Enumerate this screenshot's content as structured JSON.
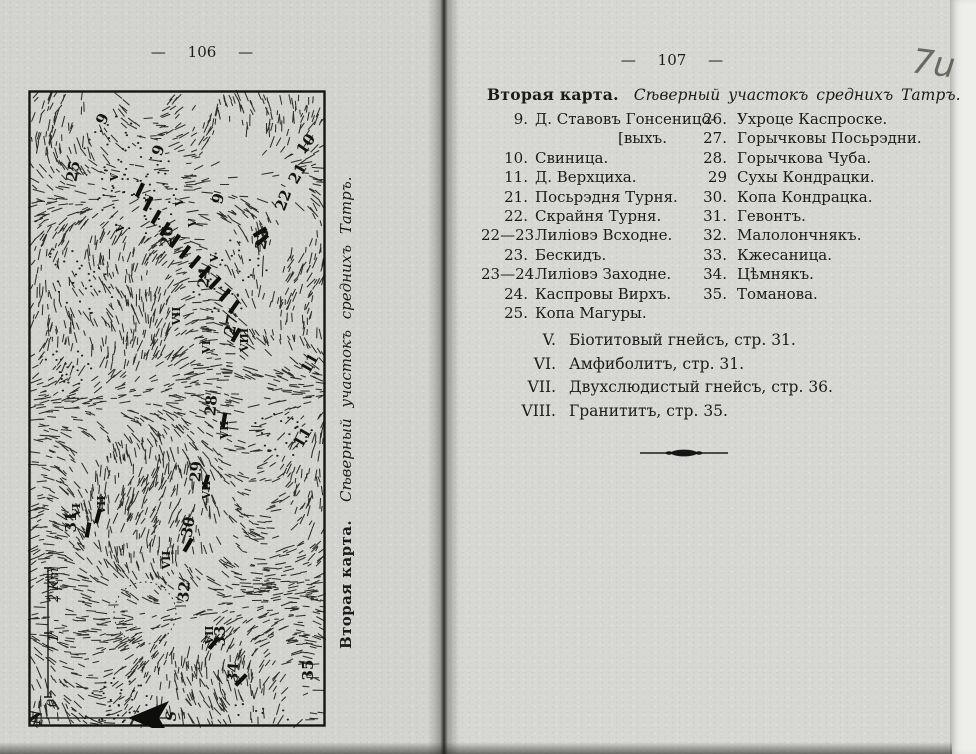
{
  "colors": {
    "ink": "#1b1b1b",
    "paper_left": "#d3d3cf",
    "paper_right": "#d7d7d3"
  },
  "scan": {
    "handwritten_mark": "7u"
  },
  "left_page": {
    "page_number": "— 106 —",
    "caption_bold": "Вторая карта.",
    "caption_italic": "Сѣверный участокъ среднихъ Татръ.",
    "map": {
      "labels": [
        {
          "t": "9",
          "x": 79,
          "y": 31,
          "r": -65
        },
        {
          "t": "9",
          "x": 135,
          "y": 62,
          "r": -70
        },
        {
          "t": "9",
          "x": 195,
          "y": 110,
          "r": -75
        },
        {
          "t": "25",
          "x": 50,
          "y": 82,
          "r": -80
        },
        {
          "t": "10",
          "x": 282,
          "y": 57,
          "r": -55
        },
        {
          "t": "21",
          "x": 274,
          "y": 86,
          "r": -60
        },
        {
          "t": "22",
          "x": 260,
          "y": 112,
          "r": -70
        },
        {
          "t": "23",
          "x": 239,
          "y": 150,
          "r": -80
        },
        {
          "t": "26",
          "x": 144,
          "y": 147,
          "r": -85
        },
        {
          "t": "24",
          "x": 181,
          "y": 188,
          "r": -85
        },
        {
          "t": "27",
          "x": 208,
          "y": 236,
          "r": -80
        },
        {
          "t": "11",
          "x": 286,
          "y": 276,
          "r": -60
        },
        {
          "t": "28",
          "x": 188,
          "y": 316,
          "r": -85
        },
        {
          "t": "11",
          "x": 279,
          "y": 350,
          "r": -60
        },
        {
          "t": "29",
          "x": 173,
          "y": 382,
          "r": -85
        },
        {
          "t": "31",
          "x": 48,
          "y": 432,
          "r": -90
        },
        {
          "t": "30",
          "x": 165,
          "y": 438,
          "r": -80
        },
        {
          "t": "32",
          "x": 161,
          "y": 502,
          "r": -85
        },
        {
          "t": "33",
          "x": 197,
          "y": 546,
          "r": -90
        },
        {
          "t": "34",
          "x": 210,
          "y": 583,
          "r": -85
        },
        {
          "t": "35",
          "x": 285,
          "y": 580,
          "r": -90
        }
      ],
      "roman_labels": [
        {
          "t": "V",
          "x": 90,
          "y": 87
        },
        {
          "t": "V",
          "x": 96,
          "y": 138
        },
        {
          "t": "V",
          "x": 125,
          "y": 108
        },
        {
          "t": "V",
          "x": 155,
          "y": 112
        },
        {
          "t": "V",
          "x": 168,
          "y": 133
        },
        {
          "t": "V",
          "x": 190,
          "y": 168
        },
        {
          "t": "VII",
          "x": 152,
          "y": 226
        },
        {
          "t": "VI",
          "x": 182,
          "y": 257
        },
        {
          "t": "VIII",
          "x": 220,
          "y": 250
        },
        {
          "t": "VII",
          "x": 200,
          "y": 340
        },
        {
          "t": "VII",
          "x": 182,
          "y": 400
        },
        {
          "t": "VI",
          "x": 52,
          "y": 420
        },
        {
          "t": "VII",
          "x": 77,
          "y": 415
        },
        {
          "t": "VII",
          "x": 142,
          "y": 470
        },
        {
          "t": "VII",
          "x": 185,
          "y": 545
        }
      ],
      "scale": {
        "label_top": "2 Km",
        "label_mid": "1",
        "label_bottom": "0"
      },
      "compass": {
        "north": "N",
        "south": "S"
      }
    }
  },
  "right_page": {
    "page_number": "— 107 —",
    "heading_bold": "Вторая карта.",
    "heading_italic": "Сѣверный участокъ среднихъ Татръ.",
    "columns": [
      {
        "items": [
          {
            "num": "9.",
            "name": "Д. Ставовъ Гонсеницо-",
            "cont": "[выхъ."
          },
          {
            "num": "10.",
            "name": "Свиница."
          },
          {
            "num": "11.",
            "name": "Д. Верхциха."
          },
          {
            "num": "21.",
            "name": "Посьрэдня Турня."
          },
          {
            "num": "22.",
            "name": "Скрайня Турня."
          },
          {
            "num": "22—23",
            "name": "Лиліовэ Всходне."
          },
          {
            "num": "23.",
            "name": "Бескидъ."
          },
          {
            "num": "23—24",
            "name": "Лиліовэ Заходне."
          },
          {
            "num": "24.",
            "name": "Каспровы Вирхъ."
          },
          {
            "num": "25.",
            "name": "Копа Магуры."
          }
        ]
      },
      {
        "items": [
          {
            "num": "26.",
            "name": "Ухроце Каспроске."
          },
          {
            "num": "27.",
            "name": "Горычковы Посьрэдни."
          },
          {
            "num": "28.",
            "name": "Горычкова Чуба."
          },
          {
            "num": "29",
            "name": "Сухы Кондрацки."
          },
          {
            "num": "30.",
            "name": "Копа Кондрацка."
          },
          {
            "num": "31.",
            "name": "Гевонтъ."
          },
          {
            "num": "32.",
            "name": "Малолончнякъ."
          },
          {
            "num": "33.",
            "name": "Кжесаница."
          },
          {
            "num": "34.",
            "name": "Цѣмнякъ."
          },
          {
            "num": "35.",
            "name": "Томанова."
          }
        ]
      }
    ],
    "rock_types": [
      {
        "numeral": "V.",
        "text": "Біотитовый гнейсъ, стр. 31."
      },
      {
        "numeral": "VI.",
        "text": "Амфиболитъ, стр. 31."
      },
      {
        "numeral": "VII.",
        "text": "Двухслюдистый гнейсъ, стр. 36."
      },
      {
        "numeral": "VIII.",
        "text": "Гранититъ, стр. 35."
      }
    ]
  }
}
